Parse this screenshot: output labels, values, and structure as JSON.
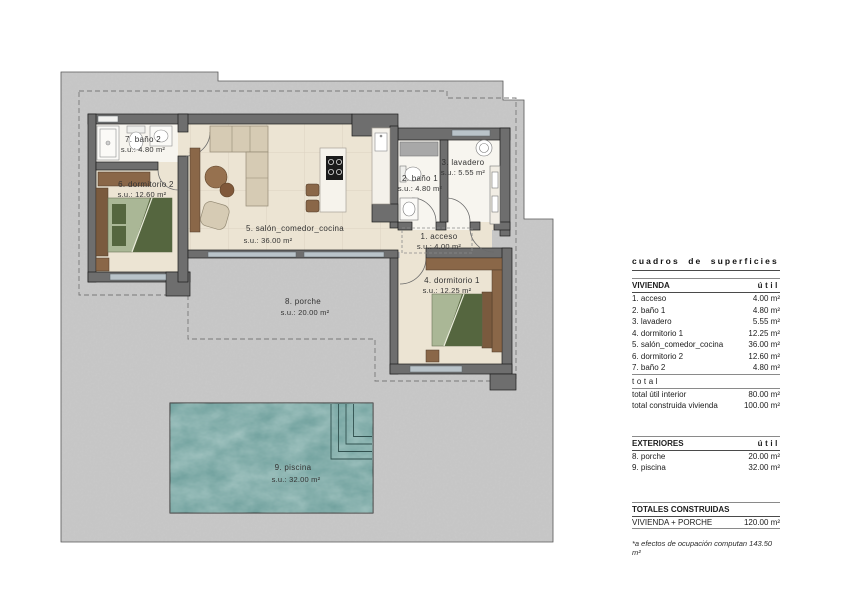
{
  "plan": {
    "rooms": [
      {
        "name": "1. acceso",
        "area": "s.u.: 4.00 m²"
      },
      {
        "name": "2. baño 1",
        "area": "s.u.: 4.80 m²"
      },
      {
        "name": "3. lavadero",
        "area": "s.u.: 5.55 m²"
      },
      {
        "name": "4. dormitorio 1",
        "area": "s.u.: 12.25 m²"
      },
      {
        "name": "5. salón_comedor_cocina",
        "area": "s.u.: 36.00 m²"
      },
      {
        "name": "6. dormitorio 2",
        "area": "s.u.: 12.60 m²"
      },
      {
        "name": "7. baño 2",
        "area": "s.u.: 4.80 m²"
      },
      {
        "name": "8. porche",
        "area": "s.u.: 20.00 m²"
      },
      {
        "name": "9. piscina",
        "area": "s.u.: 32.00 m²"
      }
    ],
    "colors": {
      "terrain": "#c9c9c9",
      "wall": "#6e6e6e",
      "floor": "#ece4d3",
      "bath_floor": "#f7f5ef",
      "pool": "#679a97",
      "wood": "#8a6748",
      "wood_dark": "#7a5a3e",
      "bed": "#aab796",
      "bed_dark": "#55663f",
      "glass": "#b9c3c9",
      "sofa": "#d6cbb4"
    }
  },
  "table": {
    "title": "cuadros de superficies",
    "vivienda": {
      "header": "VIVIENDA",
      "unit_col": "útil",
      "rows": [
        {
          "label": "1. acceso",
          "value": "4.00 m²"
        },
        {
          "label": "2. baño 1",
          "value": "4.80 m²"
        },
        {
          "label": "3. lavadero",
          "value": "5.55 m²"
        },
        {
          "label": "4. dormitorio 1",
          "value": "12.25 m²"
        },
        {
          "label": "5. salón_comedor_cocina",
          "value": "36.00 m²"
        },
        {
          "label": "6. dormitorio 2",
          "value": "12.60 m²"
        },
        {
          "label": "7. baño 2",
          "value": "4.80 m²"
        }
      ],
      "total_label": "total",
      "totals": [
        {
          "label": "total útil interior",
          "value": "80.00 m²"
        },
        {
          "label": "total construida vivienda",
          "value": "100.00 m²"
        }
      ]
    },
    "exteriores": {
      "header": "EXTERIORES",
      "unit_col": "útil",
      "rows": [
        {
          "label": "8. porche",
          "value": "20.00 m²"
        },
        {
          "label": "9. piscina",
          "value": "32.00 m²"
        }
      ]
    },
    "totales": {
      "header": "TOTALES CONSTRUIDAS",
      "rows": [
        {
          "label": "VIVIENDA + PORCHE",
          "value": "120.00 m²"
        }
      ]
    },
    "footnote": "*a efectos de ocupación computan 143.50 m²"
  }
}
